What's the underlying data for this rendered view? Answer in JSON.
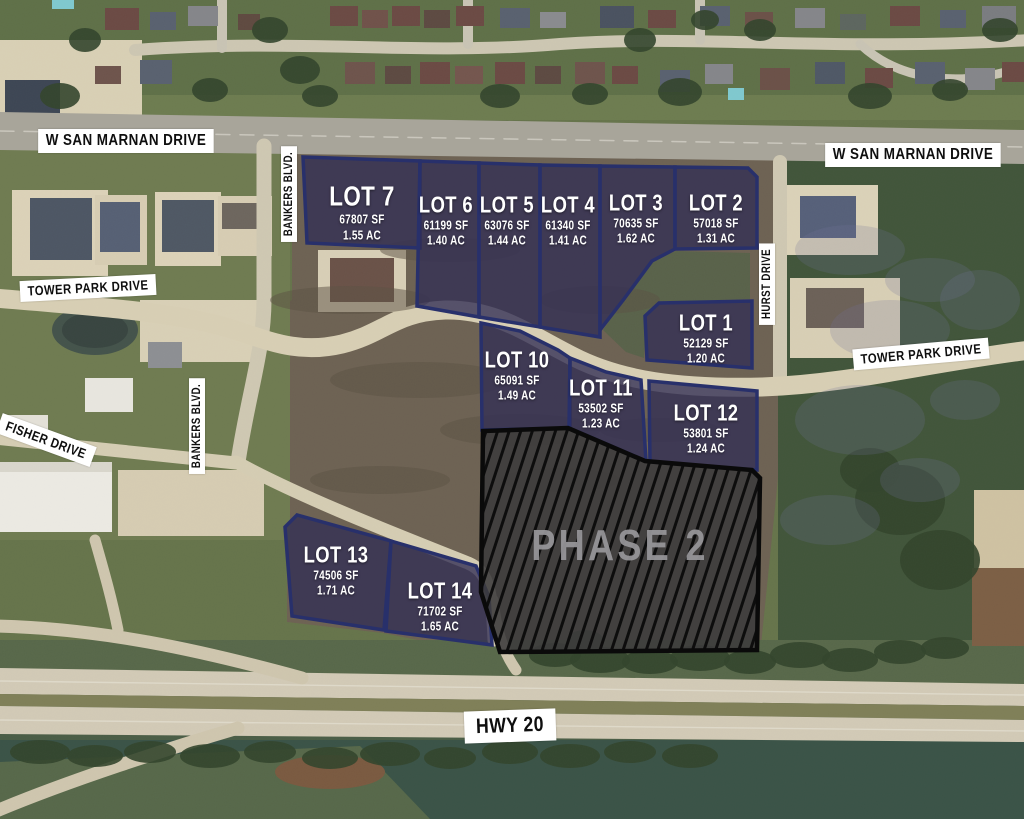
{
  "map": {
    "phase_label": "PHASE 2",
    "streets": {
      "san_marnan_left": "W SAN MARNAN DRIVE",
      "san_marnan_right": "W SAN MARNAN DRIVE",
      "bankers_top": "BANKERS BLVD.",
      "bankers_lower": "BANKERS BLVD.",
      "tower_park_left": "TOWER PARK DRIVE",
      "tower_park_right": "TOWER PARK DRIVE",
      "hurst": "HURST DRIVE",
      "fisher": "FISHER DRIVE",
      "hwy20": "HWY 20"
    },
    "lots": [
      {
        "name": "LOT 1",
        "sf": "52129 SF",
        "ac": "1.20 AC"
      },
      {
        "name": "LOT 2",
        "sf": "57018 SF",
        "ac": "1.31 AC"
      },
      {
        "name": "LOT 3",
        "sf": "70635 SF",
        "ac": "1.62 AC"
      },
      {
        "name": "LOT 4",
        "sf": "61340 SF",
        "ac": "1.41 AC"
      },
      {
        "name": "LOT 5",
        "sf": "63076 SF",
        "ac": "1.44 AC"
      },
      {
        "name": "LOT 6",
        "sf": "61199 SF",
        "ac": "1.40 AC"
      },
      {
        "name": "LOT 7",
        "sf": "67807 SF",
        "ac": "1.55 AC"
      },
      {
        "name": "LOT 10",
        "sf": "65091 SF",
        "ac": "1.49 AC"
      },
      {
        "name": "LOT 11",
        "sf": "53502 SF",
        "ac": "1.23 AC"
      },
      {
        "name": "LOT 12",
        "sf": "53801 SF",
        "ac": "1.24 AC"
      },
      {
        "name": "LOT 13",
        "sf": "74506 SF",
        "ac": "1.71 AC"
      },
      {
        "name": "LOT 14",
        "sf": "71702 SF",
        "ac": "1.65 AC"
      }
    ],
    "colors": {
      "lot_fill": "#45425a",
      "lot_border": "#28306b",
      "phase_fill": "#3c3b3c",
      "phase_hatch": "#0d0d0d",
      "phase_text": "#98979b",
      "label_bg": "#ffffff",
      "label_text": "#0e0e0e"
    }
  }
}
